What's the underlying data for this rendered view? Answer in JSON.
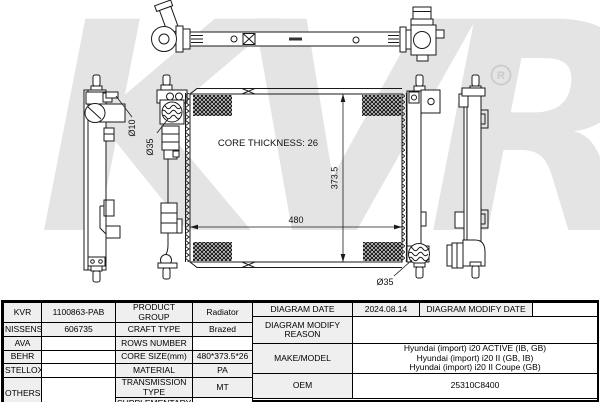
{
  "watermark": {
    "text": "KVR",
    "registered": "R"
  },
  "colors": {
    "line": "#1a1a1a",
    "watermark_gray": "#e4e4e4",
    "label_cell_bg": "#efefef",
    "hatch_black": "#111111"
  },
  "diagram": {
    "core_thickness_label": "CORE THICKNESS: 26",
    "width_dim": "480",
    "height_dim": "373.5",
    "inlet_diameter": "Ø35",
    "outlet_diameter": "Ø35",
    "bleed_pipe_diameter": "Ø10"
  },
  "table": {
    "left": {
      "rows": [
        {
          "brand": "KVR",
          "part": "1100863-PAB",
          "label": "PRODUCT GROUP",
          "value": "Radiator"
        },
        {
          "brand": "NISSENS",
          "part": "606735",
          "label": "CRAFT TYPE",
          "value": "Brazed"
        },
        {
          "brand": "AVA",
          "part": "",
          "label": "ROWS NUMBER",
          "value": ""
        },
        {
          "brand": "BEHR",
          "part": "",
          "label": "CORE SIZE(mm)",
          "value": "480*373.5*26"
        },
        {
          "brand": "STELLOX",
          "part": "",
          "label": "MATERIAL",
          "value": "PA"
        },
        {
          "brand": "OTHERS",
          "part": "",
          "label": "TRANSMISSION TYPE",
          "value": "MT"
        },
        {
          "label": "SUPPLEMENTARY",
          "value": ""
        }
      ]
    },
    "right": {
      "diagram_date_label": "DIAGRAM DATE",
      "diagram_date": "2024.08.14",
      "modify_date_label": "DIAGRAM MODIFY DATE",
      "modify_date": "",
      "modify_reason_label": "DIAGRAM MODIFY REASON",
      "modify_reason": "",
      "make_model_label": "MAKE/MODEL",
      "make_model": [
        "Hyundai (import) i20 ACTIVE (IB, GB)",
        "Hyundai (import) i20 II (GB, IB)",
        "Hyundai (import) i20 II Coupe (GB)"
      ],
      "oem_label": "OEM",
      "oem": "25310C8400"
    }
  }
}
